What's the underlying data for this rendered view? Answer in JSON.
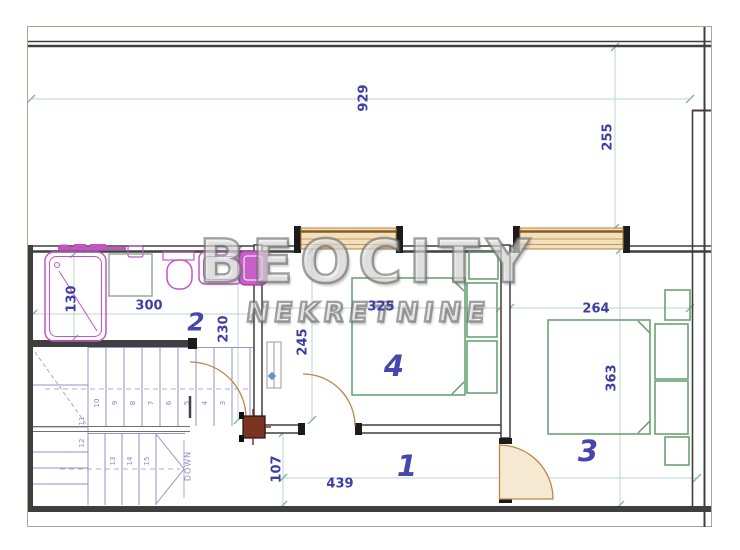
{
  "watermark": {
    "title": "BEOCITY",
    "subtitle": "NEKRETNINE"
  },
  "rooms": {
    "hall": "1",
    "bathroom": "2",
    "bedroom_right": "3",
    "bedroom_center": "4"
  },
  "dimensions": {
    "terrace_width": "929",
    "terrace_depth": "255",
    "bathroom_width": "300",
    "bathtub_length": "130",
    "bathroom_depth": "230",
    "room4_depth": "245",
    "room4_width": "325",
    "room3_width": "264",
    "room3_depth": "363",
    "hall_width": "107",
    "hall_length": "439"
  },
  "stairs": {
    "down_label": "DOWN",
    "tread_numbers": [
      "10",
      "9",
      "8",
      "7",
      "6",
      "5",
      "4",
      "3",
      "11",
      "12",
      "13",
      "14",
      "15"
    ]
  },
  "colors": {
    "wall": "#3f3f3f",
    "dimension_line": "#b9d6d4",
    "dimension_text": "#3d3da2",
    "room_number": "#4646ac",
    "stair": "#9292ca",
    "fixture_magenta": "#c653c6",
    "bed_green": "#5f9e6b",
    "window_fill": "#f2e0bd",
    "door_arc": "#c08648",
    "chimney": "#7b3322",
    "watermark_gray": "#8a8a8a"
  }
}
